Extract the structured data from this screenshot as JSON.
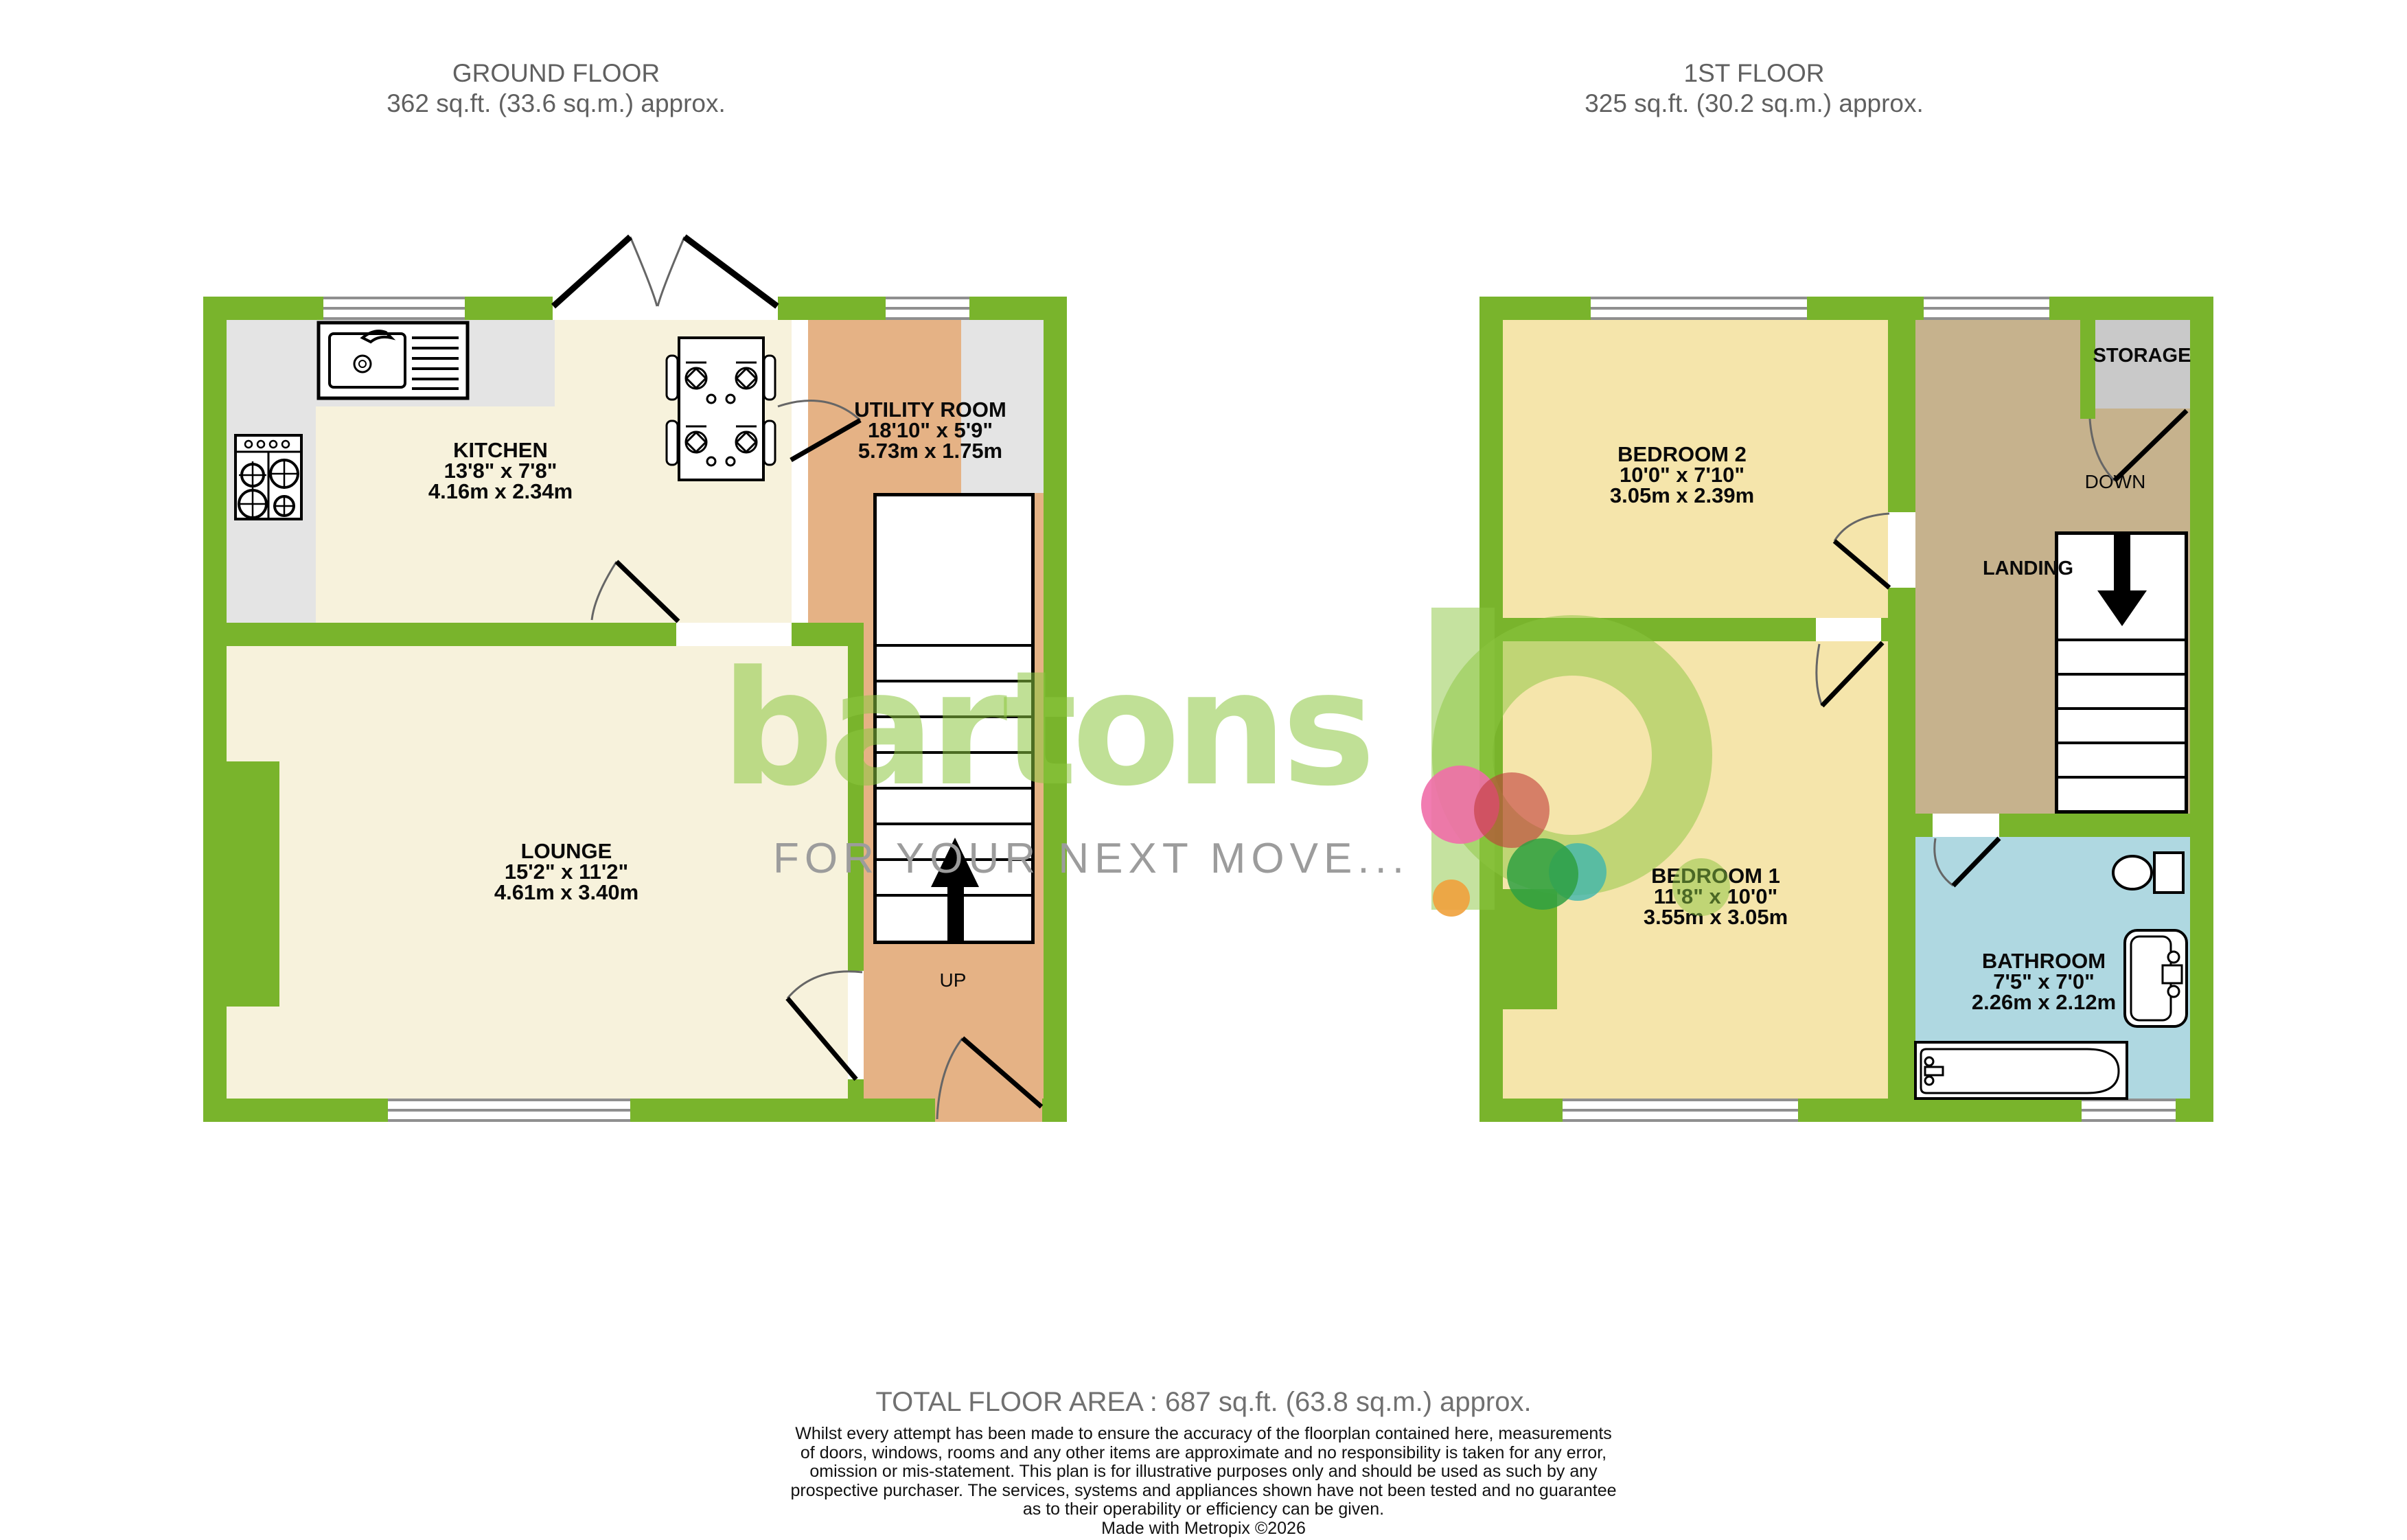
{
  "ground_floor": {
    "title": "GROUND FLOOR",
    "area": "362 sq.ft. (33.6 sq.m.) approx.",
    "rooms": {
      "kitchen": {
        "name": "KITCHEN",
        "imperial": "13'8\"  x 7'8\"",
        "metric": "4.16m  x 2.34m"
      },
      "utility": {
        "name": "UTILITY ROOM",
        "imperial": "18'10\"  x 5'9\"",
        "metric": "5.73m  x 1.75m"
      },
      "lounge": {
        "name": "LOUNGE",
        "imperial": "15'2\"  x 11'2\"",
        "metric": "4.61m  x 3.40m"
      }
    },
    "stairs_label": "UP"
  },
  "first_floor": {
    "title": "1ST FLOOR",
    "area": "325 sq.ft. (30.2 sq.m.) approx.",
    "rooms": {
      "bedroom2": {
        "name": "BEDROOM 2",
        "imperial": "10'0\"  x 7'10\"",
        "metric": "3.05m  x 2.39m"
      },
      "bedroom1": {
        "name": "BEDROOM 1",
        "imperial": "11'8\"  x 10'0\"",
        "metric": "3.55m  x 3.05m"
      },
      "bathroom": {
        "name": "BATHROOM",
        "imperial": "7'5\"  x 7'0\"",
        "metric": "2.26m  x 2.12m"
      },
      "storage": {
        "name": "STORAGE"
      },
      "landing": {
        "name": "LANDING"
      }
    },
    "stairs_label": "DOWN"
  },
  "logo": {
    "brand": "bartons",
    "tagline": "FOR YOUR NEXT MOVE..."
  },
  "footer": {
    "total": "TOTAL FLOOR AREA : 687 sq.ft. (63.8 sq.m.) approx.",
    "disclaimer_lines": [
      "Whilst every attempt has been made to ensure the accuracy of the floorplan contained here, measurements",
      "of doors, windows, rooms and any other items are approximate and no responsibility is taken for any error,",
      "omission or mis-statement. This plan is for illustrative purposes only and should be used as such by any",
      "prospective purchaser. The services, systems and appliances shown have not been tested and no guarantee",
      "as to their operability or efficiency can be given."
    ],
    "credit": "Made with Metropix ©2026"
  },
  "colors": {
    "wall_green": "#79B42C",
    "room_cream": "#F7F2DC",
    "counter_grey": "#E4E4E4",
    "utility_tan": "#E5B285",
    "bedroom_yellow": "#F5E5AB",
    "landing_brown": "#C6B28D",
    "storage_grey": "#C9C9C9",
    "bathroom_blue": "#AFD8E1",
    "window_line_grey": "#8F8F8F",
    "title_grey": "#606060",
    "logo_green": "#8CC63F",
    "tagline_grey": "#9C9C9C"
  }
}
